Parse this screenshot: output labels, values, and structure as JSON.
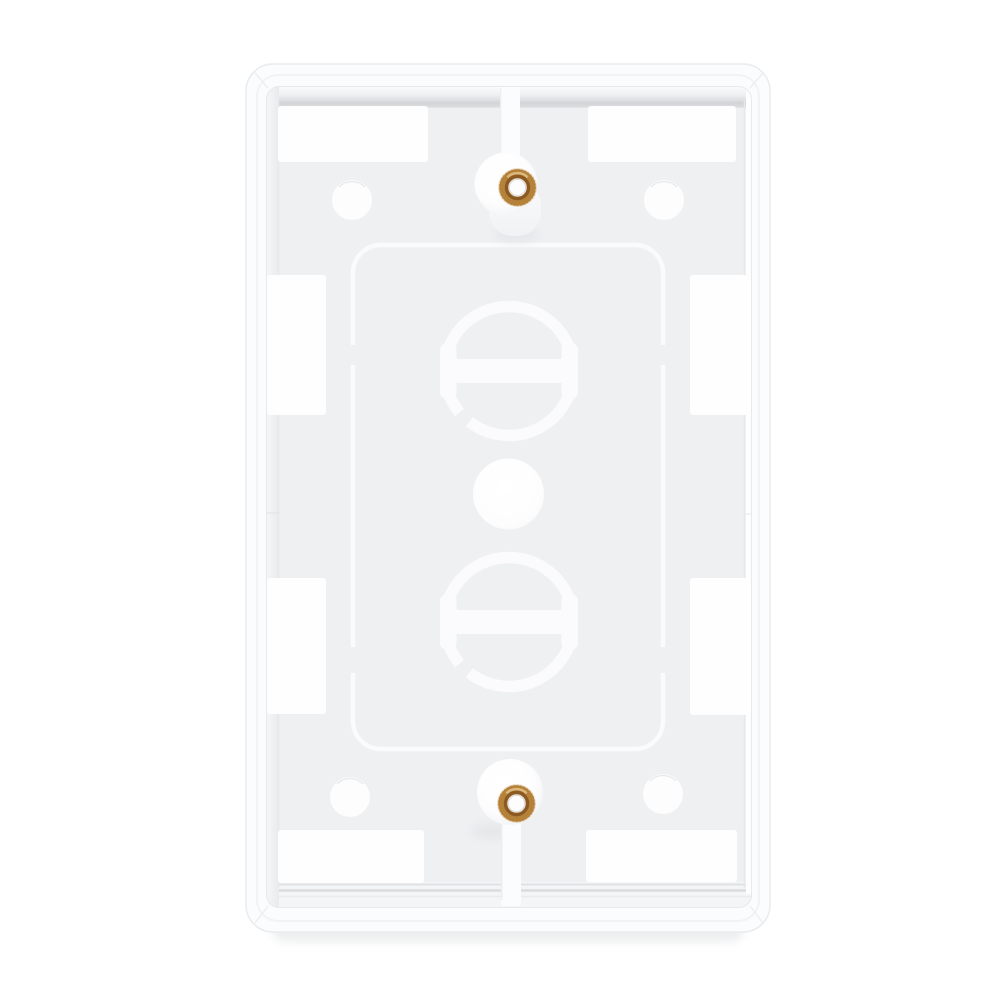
{
  "scene": {
    "type": "product-photo",
    "subject": "Rear side of a white plastic single-gang wall plate on a plain white background",
    "orientation": "portrait, centered",
    "text_content": "none"
  },
  "canvas": {
    "width": 1000,
    "height": 1000
  },
  "parts": {
    "plate": "white rectangular wall plate with rounded corners (back cavity visible)",
    "screw_inserts": "2 brass knurled threaded inserts, top and bottom center",
    "screw_bosses": "2 white cylindrical screw bosses joined to rim by vertical ribs",
    "corner_holes": "4 round molding holes near the corners",
    "circular_knockouts": "2 large circular knockouts with horizontal bar tabs",
    "center_knockout": "1 small solid round knockout disc at center",
    "scribed_outline": "rounded-rectangle scribe line around the knockout field",
    "edge_recesses": "8 bright rectangular recesses along top, bottom, left and right rim walls"
  },
  "colors": {
    "background": "#ffffff",
    "plate_face": "#fbfcfd",
    "plate_edge": "#e9ebed",
    "frame_step": "#f1f3f4",
    "floor": "#eff0f2",
    "wall_dark": "#d3d5d8",
    "wall_line": "#e6e8ea",
    "notch_white": "#fefeff",
    "hole_white": "#fdfdfe",
    "hole_rim": "#e4e6e8",
    "molding_white": "#fbfbfd",
    "boss_white": "#fbfcfd",
    "boss_side": "#f5f6f8",
    "shadow": "#dee1e3",
    "brass_knurl": "#cf9e63",
    "brass_body": "#b5823a",
    "brass_dark": "#8a5a22",
    "brass_highlight": "#dcb87f"
  }
}
